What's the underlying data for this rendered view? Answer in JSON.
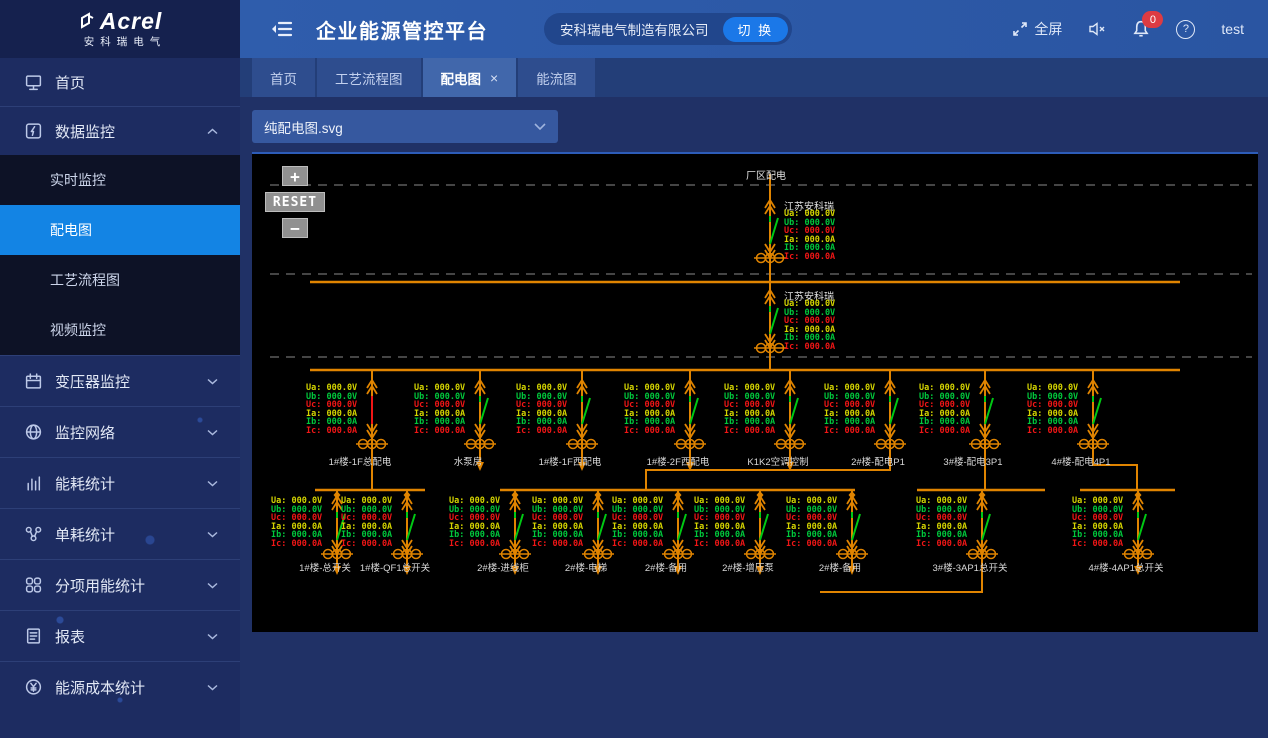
{
  "branding": {
    "logo_text": "Acrel",
    "logo_sub": "安科瑞电气"
  },
  "header": {
    "title": "企业能源管控平台",
    "company": "安科瑞电气制造有限公司",
    "switch_label": "切 换",
    "fullscreen_label": "全屏",
    "notification_count": "0",
    "username": "test"
  },
  "tabs": [
    {
      "label": "首页",
      "active": false,
      "closable": false
    },
    {
      "label": "工艺流程图",
      "active": false,
      "closable": false
    },
    {
      "label": "配电图",
      "active": true,
      "closable": true
    },
    {
      "label": "能流图",
      "active": false,
      "closable": false
    }
  ],
  "toolbar": {
    "svg_selector_value": "纯配电图.svg"
  },
  "sidebar": {
    "items": [
      {
        "name": "home",
        "label": "首页",
        "type": "single"
      },
      {
        "name": "data-monitor",
        "label": "数据监控",
        "type": "group-open",
        "children": [
          {
            "label": "实时监控",
            "active": false
          },
          {
            "label": "配电图",
            "active": true
          },
          {
            "label": "工艺流程图",
            "active": false
          },
          {
            "label": "视频监控",
            "active": false
          }
        ]
      },
      {
        "name": "transformer-monitor",
        "label": "变压器监控",
        "type": "group"
      },
      {
        "name": "monitor-network",
        "label": "监控网络",
        "type": "group"
      },
      {
        "name": "energy-stats",
        "label": "能耗统计",
        "type": "group"
      },
      {
        "name": "unit-consumption-stats",
        "label": "单耗统计",
        "type": "group"
      },
      {
        "name": "subitem-energy-stats",
        "label": "分项用能统计",
        "type": "group"
      },
      {
        "name": "reports",
        "label": "报表",
        "type": "group"
      },
      {
        "name": "energy-cost-stats",
        "label": "能源成本统计",
        "type": "group"
      }
    ]
  },
  "diagram": {
    "title": "厂区配电",
    "zoom_controls": {
      "zoom_in": "+",
      "reset": "RESET",
      "zoom_out": "−"
    },
    "colors": {
      "bus": "#e08400",
      "switch_green": "#00c814",
      "switch_red": "#f01616",
      "phase_a": "#d4d400",
      "phase_b": "#00c83c",
      "phase_c": "#f01616",
      "label": "#d8d8d8"
    },
    "readings_rows": [
      {
        "label": "Ua:",
        "value": "000.0V",
        "phase": "a"
      },
      {
        "label": "Ub:",
        "value": "000.0V",
        "phase": "b"
      },
      {
        "label": "Uc:",
        "value": "000.0V",
        "phase": "c"
      },
      {
        "label": "Ia:",
        "value": "000.0A",
        "phase": "a"
      },
      {
        "label": "Ib:",
        "value": "000.0A",
        "phase": "b"
      },
      {
        "label": "Ic:",
        "value": "000.0A",
        "phase": "c"
      }
    ],
    "incomers": [
      {
        "name": "江苏安科瑞",
        "x": 518,
        "line_top": 20,
        "line_bottom": 128,
        "breaker_top": 46,
        "switch": "green"
      },
      {
        "name": "江苏安科瑞",
        "x": 518,
        "line_top": 128,
        "line_bottom": 216,
        "breaker_top": 136,
        "switch": "green"
      }
    ],
    "buses": [
      {
        "x1": 58,
        "x2": 928,
        "y": 128
      },
      {
        "x1": 58,
        "x2": 928,
        "y": 216
      },
      {
        "x1": 63,
        "x2": 173,
        "y": 336
      },
      {
        "x1": 248,
        "x2": 603,
        "y": 336
      },
      {
        "x1": 665,
        "x2": 793,
        "y": 336
      },
      {
        "x1": 828,
        "x2": 923,
        "y": 336
      }
    ],
    "dashed_lines": [
      31,
      120,
      203
    ],
    "top_feeders": [
      {
        "label": "1#楼-1F总配电",
        "x": 120,
        "switch": "red",
        "drop": "none"
      },
      {
        "label": "水泵房",
        "x": 228,
        "switch": "green",
        "drop": "arrow"
      },
      {
        "label": "1#楼-1F西配电",
        "x": 330,
        "switch": "green",
        "drop": "arrow"
      },
      {
        "label": "1#楼-2F西配电",
        "x": 438,
        "switch": "green",
        "drop": "arrow"
      },
      {
        "label": "K1K2空调控制",
        "x": 538,
        "switch": "green",
        "drop": "arrow"
      },
      {
        "label": "2#楼-配电P1",
        "x": 638,
        "switch": "green",
        "drop": "none"
      },
      {
        "label": "3#楼-配电3P1",
        "x": 733,
        "switch": "green",
        "drop": "none"
      },
      {
        "label": "4#楼-配电4P1",
        "x": 841,
        "switch": "green",
        "drop": "none"
      }
    ],
    "bottom_feeders": [
      {
        "label": "1#楼-总开关",
        "x": 85,
        "switch": "green",
        "drop": "arrow"
      },
      {
        "label": "1#楼-QF1总开关",
        "x": 155,
        "switch": "green",
        "drop": "arrow"
      },
      {
        "label": "2#楼-进线柜",
        "x": 263,
        "switch": "green",
        "drop": "arrow"
      },
      {
        "label": "2#楼-电梯",
        "x": 346,
        "switch": "green",
        "drop": "arrow"
      },
      {
        "label": "2#楼-备用",
        "x": 426,
        "switch": "green",
        "drop": "arrow"
      },
      {
        "label": "2#楼-增压泵",
        "x": 508,
        "switch": "green",
        "drop": "arrow"
      },
      {
        "label": "2#楼-备用",
        "x": 600,
        "switch": "green",
        "drop": "arrow"
      },
      {
        "label": "3#楼-3AP1总开关",
        "x": 730,
        "switch": "green",
        "drop": "none"
      },
      {
        "label": "4#楼-4AP1总开关",
        "x": 886,
        "switch": "green",
        "drop": "arrow"
      }
    ],
    "connectors": [
      {
        "points": "120,296 120,336"
      },
      {
        "points": "638,296 638,316 394,316 394,336"
      },
      {
        "points": "733,296 733,336"
      },
      {
        "points": "841,296 841,311 885,311 885,336"
      },
      {
        "points": "730,400 730,438 568,438"
      }
    ]
  }
}
